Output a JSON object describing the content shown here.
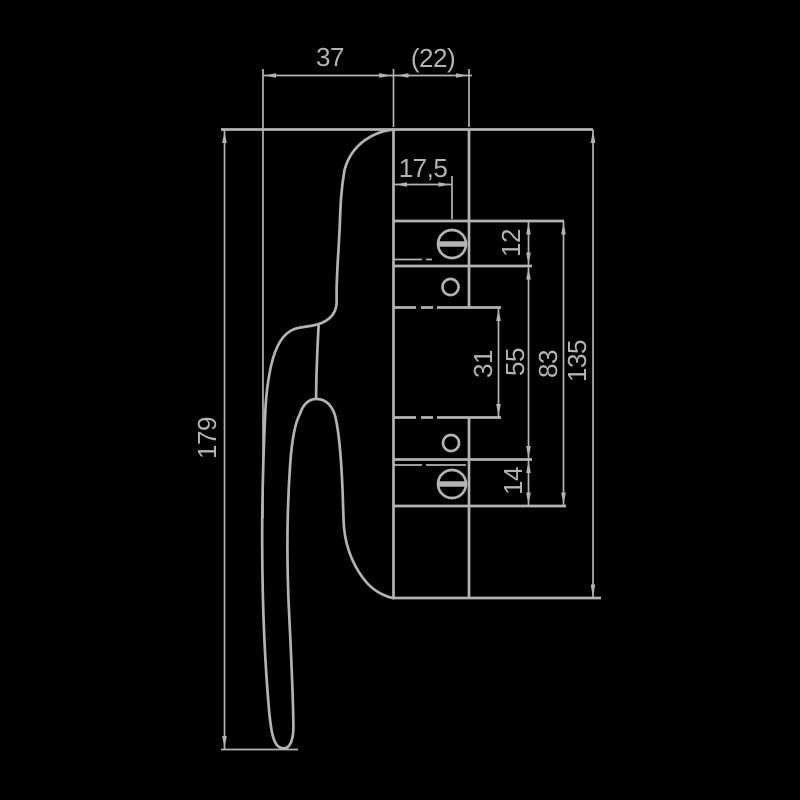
{
  "colors": {
    "background": "#000000",
    "line": "#b3b3b3",
    "text": "#b3b3b3"
  },
  "drawing": {
    "kind": "window-handle side-view technical drawing",
    "units_style": "DIN dimension figures, decimal comma"
  },
  "dims": [
    {
      "id": "width-37",
      "label": "37"
    },
    {
      "id": "depth-22",
      "label": "(22)"
    },
    {
      "id": "offset-17-5",
      "label": "17,5"
    },
    {
      "id": "seg-12",
      "label": "12"
    },
    {
      "id": "seg-31",
      "label": "31"
    },
    {
      "id": "seg-55",
      "label": "55"
    },
    {
      "id": "seg-83",
      "label": "83"
    },
    {
      "id": "seg-135",
      "label": "135"
    },
    {
      "id": "seg-14",
      "label": "14"
    },
    {
      "id": "length-179",
      "label": "179"
    }
  ]
}
